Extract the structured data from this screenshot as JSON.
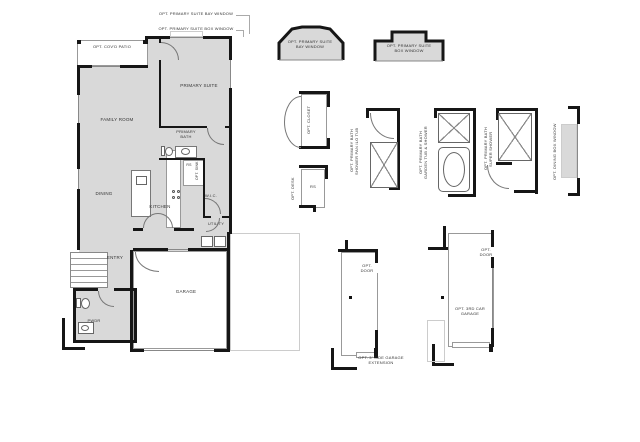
{
  "notes": {
    "bay_window": "OPT. PRIMARY SUITE BAY WINDOW",
    "box_window": "OPT. PRIMARY SUITE BOX WINDOW"
  },
  "rooms": {
    "patio": "OPT. COV'D PATIO",
    "family_room": "FAMILY ROOM",
    "primary_suite": "PRIMARY SUITE",
    "primary_bath": "PRIMARY BATH",
    "refrigerator_space": "RS",
    "opt_sink": "OPT. SINK",
    "dining": "DINING",
    "kitchen": "KITCHEN",
    "wic": "W.I.C.",
    "utility": "UTILITY",
    "entry": "ENTRY",
    "garage": "GARAGE",
    "pwdr": "PWDR"
  },
  "options": {
    "bay_window": {
      "line1": "OPT. PRIMARY SUITE",
      "line2": "BAY WINDOW"
    },
    "box_window": {
      "line1": "OPT. PRIMARY SUITE",
      "line2": "BOX WINDOW"
    },
    "closet": {
      "label": "OPT. CLOSET"
    },
    "desk": {
      "label": "OPT. DESK",
      "inner": "RS"
    },
    "shower_pan": {
      "line1": "OPT. PRIMARY BATH",
      "line2": "SHOWER PAN ILO TUB"
    },
    "garden_tub": {
      "line1": "OPT. PRIMARY BATH",
      "line2": "GARDEN TUB & SHOWER"
    },
    "super_shower": {
      "line1": "OPT. PRIMARY BATH",
      "line2": "SUPER SHOWER"
    },
    "dining_box_window": {
      "label": "OPT. DINING BOX WINDOW"
    },
    "garage_extension": {
      "door": "OPT. DOOR",
      "label": "OPT. 3' SIDE GARAGE EXTENSION"
    },
    "third_car_garage": {
      "door": "OPT. DOOR",
      "label": "OPT. 3RD CAR GARAGE"
    }
  },
  "colors": {
    "wall": "#161616",
    "room_fill": "#d9d9d9",
    "line": "#888888",
    "label": "#333333",
    "background": "#ffffff"
  }
}
